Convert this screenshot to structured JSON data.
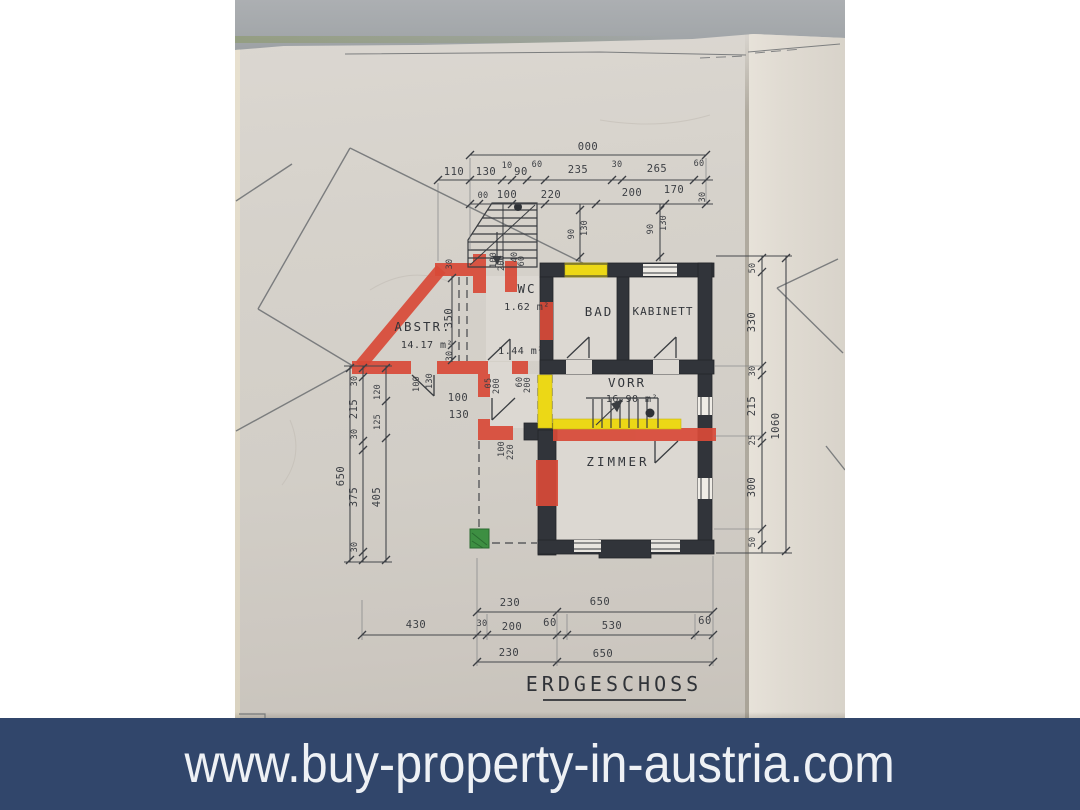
{
  "banner": {
    "url_text": "www.buy-property-in-austria.com",
    "bg_color": "#31466b",
    "text_color": "#eef1f5"
  },
  "plan": {
    "title": "ERDGESCHOSS",
    "rooms": {
      "abstr": {
        "name": "ABSTR.",
        "area": "14.17 m²"
      },
      "wc": {
        "name": "WC",
        "area": "1.62 m²"
      },
      "bad": {
        "name": "BAD"
      },
      "kabinett": {
        "name": "KABINETT"
      },
      "vorr": {
        "name": "VORR",
        "area": "16.90 m²"
      },
      "zimmer": {
        "name": "ZIMMER"
      },
      "lobby_area": "1.44 m²"
    },
    "highlight_colors": {
      "existing_wall": "#31343a",
      "new_wall_red": "#d94a38",
      "yellow": "#ecd816",
      "green": "#3d8f42"
    },
    "dims": {
      "top_overall": "000",
      "top_row2": [
        "110",
        "130",
        "10",
        "90",
        "60",
        "235",
        "30",
        "265",
        "60"
      ],
      "top_row3": [
        "00",
        "100",
        "220",
        "200",
        "170",
        "30"
      ],
      "stair_pairs": [
        "90",
        "130",
        "90",
        "130"
      ],
      "wall_small": [
        "100",
        "200",
        "40",
        "60",
        "05",
        "200",
        "60",
        "200",
        "100",
        "130",
        "100",
        "220"
      ],
      "abstr_dims": [
        "30",
        "350",
        "30"
      ],
      "opening_dims": [
        "100",
        "130"
      ],
      "left_overall": "650",
      "left_chain": [
        "30",
        "215",
        "30",
        "375",
        "30"
      ],
      "left_inner": [
        "120",
        "125",
        "405"
      ],
      "right_overall": "1060",
      "right_chain": [
        "50",
        "330",
        "30",
        "215",
        "25",
        "300",
        "50"
      ],
      "bottom_row1": [
        "230",
        "650"
      ],
      "bottom_row2": [
        "430",
        "30",
        "200",
        "60",
        "530",
        "60"
      ],
      "bottom_row3": [
        "230",
        "650"
      ]
    }
  }
}
